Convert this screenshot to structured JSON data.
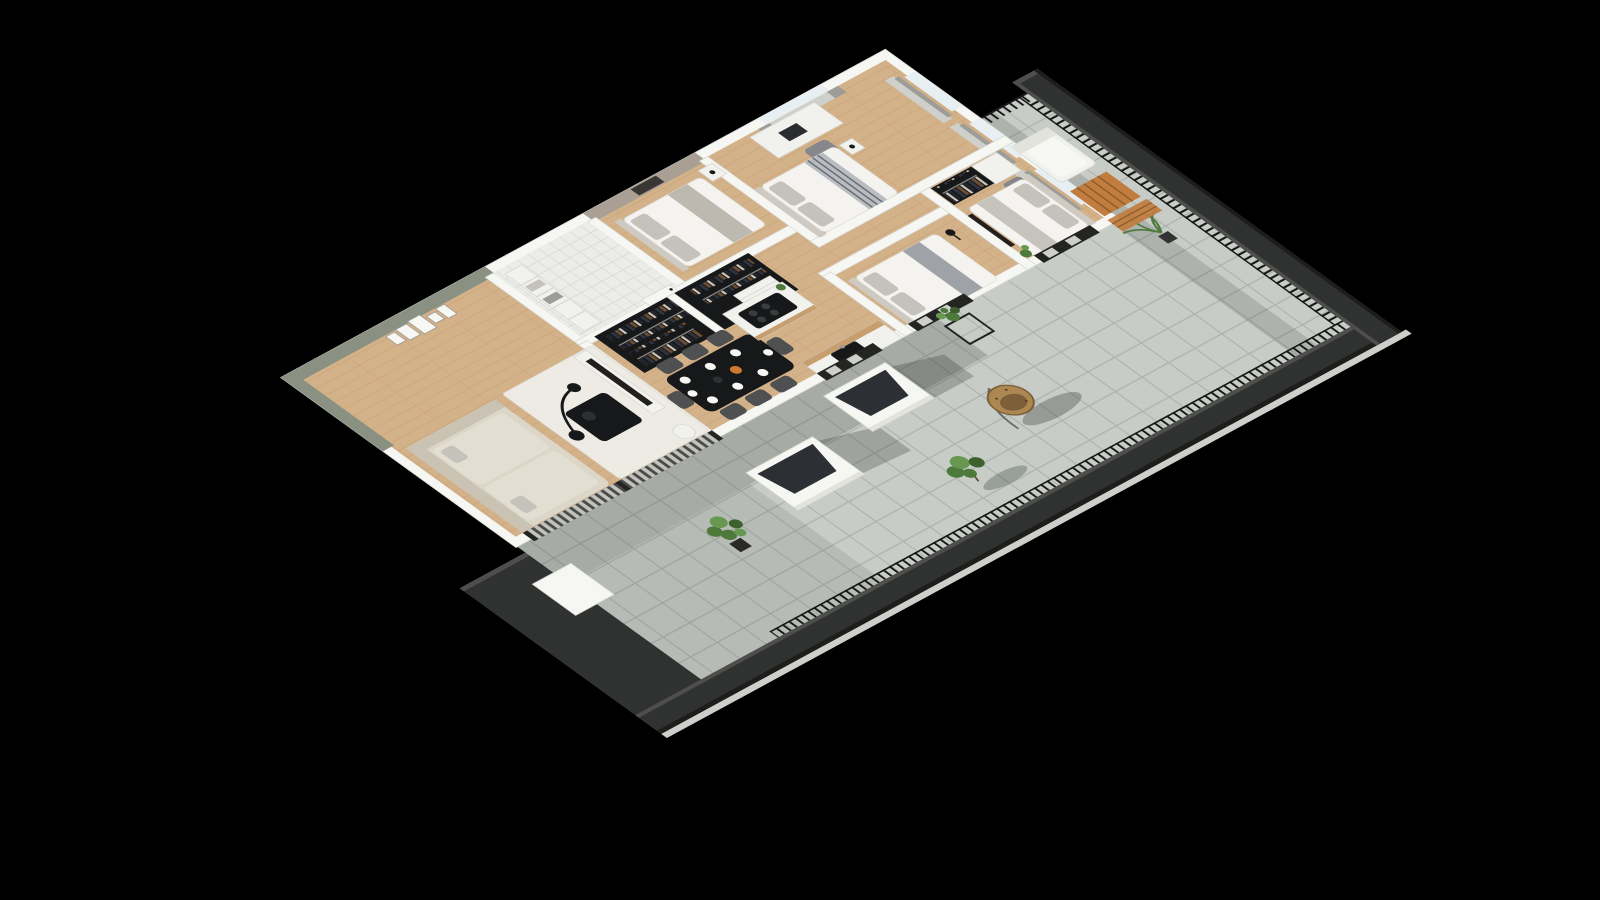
{
  "scene": {
    "type": "3d-floorplan-render",
    "description": "Cutaway axonometric render of an apartment with a wraparound tiled terrace on a black background",
    "visible_text": "none"
  },
  "palette": {
    "bg": "#000000",
    "wall": "#f6f6f3",
    "wallEdge": "#d7d7d2",
    "wallShade": "#e3e3de",
    "green": "#8a9182",
    "taupe": "#a99f94",
    "artDark": "#3a3633",
    "wood": "#d3b189",
    "woodLine": "#b98f5f",
    "tile": "#ecedea",
    "tileLine": "#d8d9d5",
    "terrace": "#c7cdc6",
    "terraceLine": "#a7ada6",
    "terrShadow": "#232823",
    "parapet": "#303131",
    "parapetEdge": "#4e4f4c",
    "parapetDark": "#1d1d1c",
    "sliver": "#e4e4e0",
    "railing": "#161616",
    "glass": "#e8eff3",
    "curtain": "#cfcfcb",
    "curtainDark": "#9c9c98",
    "sofa": "#dcd6c9",
    "sofaShade": "#cac2b2",
    "sofaCushion": "#e3ded2",
    "rug": "#edebe3",
    "black": "#17181a",
    "chairGray": "#4e5052",
    "chairLight": "#85878a",
    "plate": "#f7f7f4",
    "orange": "#cf7a33",
    "duvet": "#f4f3ef",
    "pillow": "#c5c2bc",
    "headboard": "#cfcac1",
    "blanket": "#676b72",
    "desk": "#f1f1ed",
    "counterWood": "#c79f6e",
    "cooktopBurner": "#3a3d40",
    "tv": "#221f1d",
    "plant": "#4d7a3b",
    "plantLight": "#66984f",
    "plantDark": "#3c612d",
    "rattan": "#ad8752",
    "rattanDark": "#7c5f38",
    "woodFurn": "#c07d3f",
    "woodFurnDark": "#8f5c28",
    "slatLight": "#d8d8d2",
    "slatDark": "#4a4b49",
    "frameDark": "#242422"
  },
  "inventory": {
    "rooms": [
      "living-room",
      "entry-bathroom",
      "walk-in-closet",
      "taupe-bedroom",
      "bedroom-2",
      "bedroom-3-master",
      "bedroom-1",
      "open-kitchen"
    ],
    "terrace_items": [
      "skylight-box",
      "skylight-box",
      "egg-chair",
      "fiddle-plant",
      "plant-stand",
      "small-tree",
      "palm-plant",
      "lounge-chair",
      "wood-slat-table",
      "railing",
      "parapet"
    ]
  }
}
